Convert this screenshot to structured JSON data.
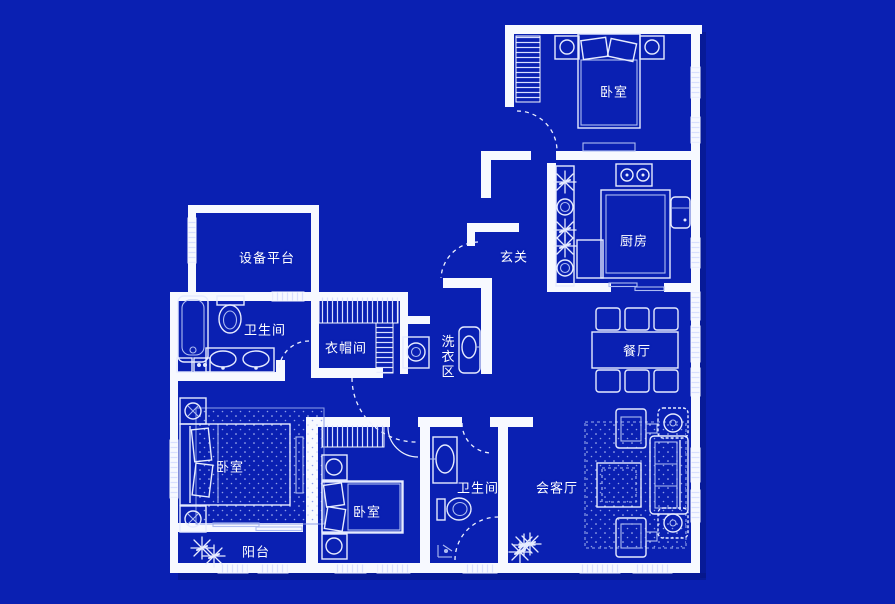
{
  "plan_title": "apartment-floor-plan-blueprint",
  "colors": {
    "background": "#0a20b2",
    "wall": "#f7f9ff",
    "furniture_line": "#e6ebff",
    "label_text": "#ffffff"
  },
  "rooms": {
    "bedroom_top": {
      "label": "卧室"
    },
    "kitchen": {
      "label": "厨房"
    },
    "entrance": {
      "label": "玄关"
    },
    "equipment_platform": {
      "label": "设备平台"
    },
    "bathroom_main": {
      "label": "卫生间"
    },
    "cloakroom": {
      "label": "衣帽间"
    },
    "laundry": {
      "label": "洗衣区"
    },
    "dining": {
      "label": "餐厅"
    },
    "bedroom_left": {
      "label": "卧室"
    },
    "bedroom_middle": {
      "label": "卧室"
    },
    "bathroom_second": {
      "label": "卫生间"
    },
    "living": {
      "label": "会客厅"
    },
    "balcony": {
      "label": "阳台"
    }
  }
}
